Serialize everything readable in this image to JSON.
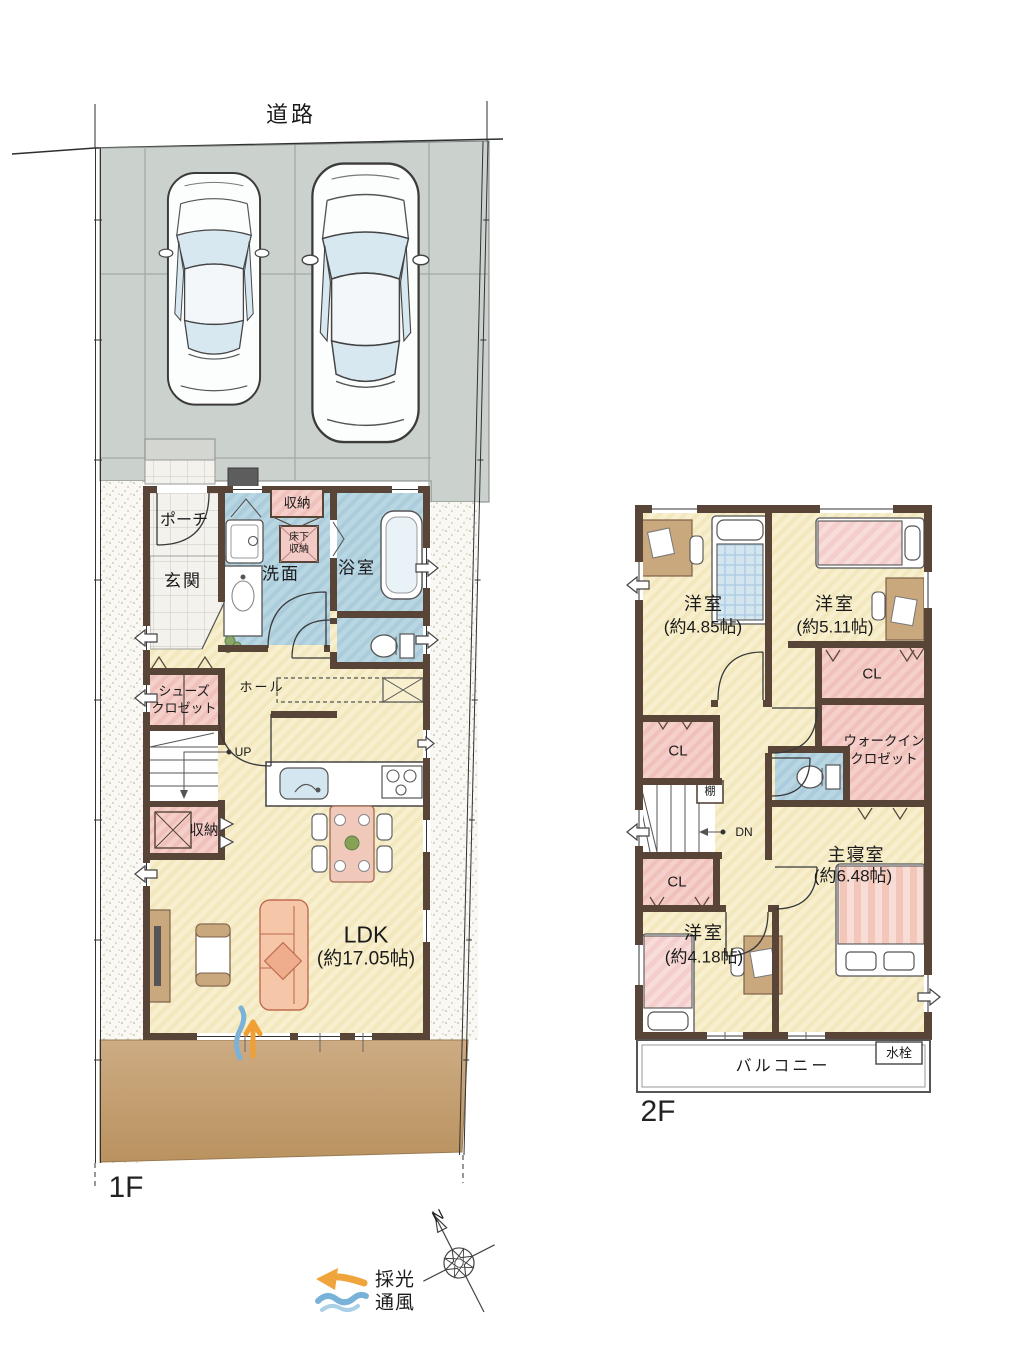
{
  "header": {
    "road": "道路"
  },
  "floor_labels": {
    "f1": "1F",
    "f2": "2F"
  },
  "compass": {
    "north": "N"
  },
  "legend": {
    "daylight": "採光",
    "ventilation": "通風"
  },
  "floor1": {
    "porch": "ポーチ",
    "entrance": "玄関",
    "storage_top": "収納",
    "underfloor_1": "床下",
    "underfloor_2": "収納",
    "washroom": "洗面",
    "bathroom": "浴室",
    "hall": "ホール",
    "shoes_1": "シューズ",
    "shoes_2": "クロゼット",
    "storage_mid": "収納",
    "up": "UP",
    "ldk": "LDK",
    "ldk_size": "(約17.05帖)"
  },
  "floor2": {
    "bed1": "洋室",
    "bed1_size": "(約4.85帖)",
    "bed2": "洋室",
    "bed2_size": "(約5.11帖)",
    "bed3": "洋室",
    "bed3_size": "(約4.18帖)",
    "master": "主寝室",
    "master_size": "(約6.48帖)",
    "cl1": "CL",
    "cl2": "CL",
    "cl3": "CL",
    "wic_1": "ウォークイン",
    "wic_2": "クロゼット",
    "shelf": "棚",
    "dn": "DN",
    "balcony": "バルコニー",
    "faucet": "水栓"
  }
}
